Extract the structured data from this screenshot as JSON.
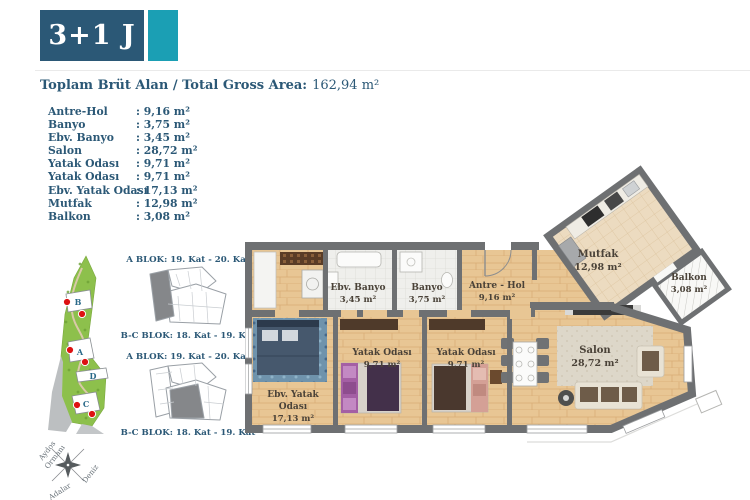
{
  "badge": {
    "unit_type": "3+1 J"
  },
  "gross_area": {
    "label": "Toplam Brüt Alan / Total Gross Area:",
    "value": "162,94 m²"
  },
  "room_list": [
    {
      "name": "Antre-Hol",
      "value": ": 9,16 m²"
    },
    {
      "name": "Banyo",
      "value": ": 3,75 m²"
    },
    {
      "name": "Ebv. Banyo",
      "value": ": 3,45 m²"
    },
    {
      "name": "Salon",
      "value": ": 28,72 m²"
    },
    {
      "name": "Yatak Odası",
      "value": ": 9,71 m²"
    },
    {
      "name": "Yatak Odası",
      "value": ": 9,71 m²"
    },
    {
      "name": "Ebv. Yatak Odası",
      "value": ": 17,13 m²"
    },
    {
      "name": "Mutfak",
      "value": ": 12,98 m²"
    },
    {
      "name": "Balkon",
      "value": ": 3,08 m²"
    }
  ],
  "block_info": {
    "caption_a": "A BLOK: 19. Kat - 20. Kat",
    "caption_bc": "B-C BLOK: 18. Kat - 19. Kat"
  },
  "site_plan": {
    "buildings": {
      "b": "B",
      "a": "A",
      "d": "D",
      "c": "C"
    },
    "compass": {
      "left_line1": "Aydos",
      "left_line2": "Ormanı",
      "right": "Deniz",
      "bottom": "Adalar"
    }
  },
  "plan_labels": {
    "mutfak": {
      "name": "Mutfak",
      "area": "12,98 m²"
    },
    "balkon": {
      "name": "Balkon",
      "area": "3,08 m²"
    },
    "ebv_banyo": {
      "name": "Ebv. Banyo",
      "area": "3,45 m²"
    },
    "banyo": {
      "name": "Banyo",
      "area": "3,75 m²"
    },
    "antre": {
      "name": "Antre - Hol",
      "area": "9,16 m²"
    },
    "yatak1": {
      "name": "Yatak Odası",
      "area": "9,71 m²"
    },
    "yatak2": {
      "name": "Yatak Odası",
      "area": "9,71 m²"
    },
    "ebv_yatak": {
      "line1": "Ebv. Yatak",
      "line2": "Odası",
      "area": "17,13 m²"
    },
    "salon": {
      "name": "Salon",
      "area": "28,72 m²"
    }
  },
  "colors": {
    "navy": "#2b5876",
    "teal": "#1b9fb4",
    "wall_gray": "#6e7072",
    "wood": "#e8c694",
    "site_green": "#8dc04c",
    "marker_red": "#dd1212",
    "plan_label_brown": "#4a4238"
  }
}
